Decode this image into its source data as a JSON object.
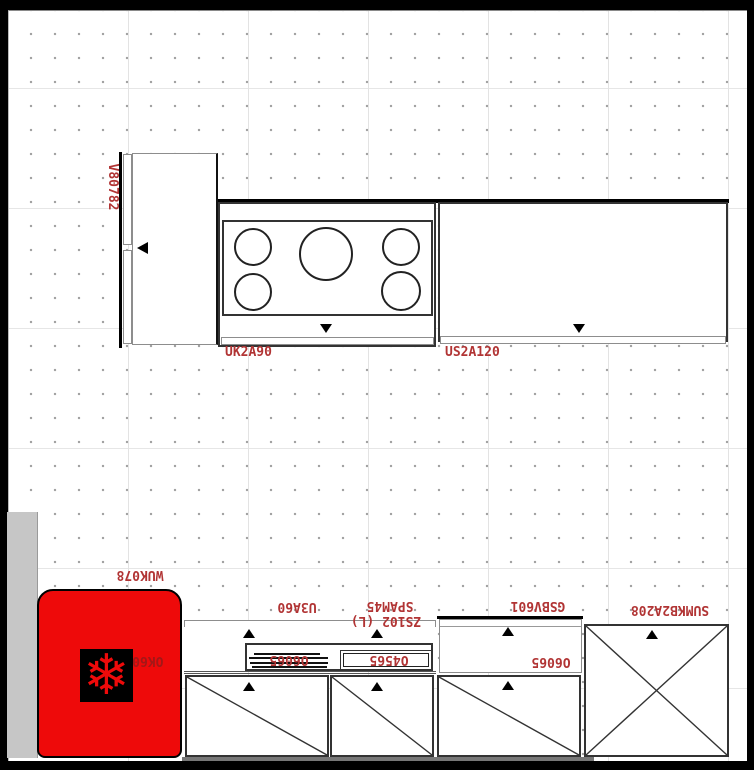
{
  "app": {
    "view_name": "kitchen-plan-canvas"
  },
  "colors": {
    "label_red": "#b13434",
    "fridge_red": "#ee0a0a",
    "fridge_model_red": "#8a1c1c",
    "line_dark": "#2a2a2a"
  },
  "icons": {
    "snowflake_glyph": "❄"
  },
  "labels": {
    "tall_cabinet": "V80782",
    "hob_cabinet": "UK2A90",
    "wide_cabinet": "US2A120",
    "fridge": "WUK078",
    "fridge_model": "OK6028",
    "wall_cabinet_small": "U3A60",
    "hood": "SPAM45",
    "sink_cabinet": "ZS102 (L)",
    "sink_drainer": "O6065",
    "sink_bowl": "O4565",
    "counter_right": "O6065",
    "upper_right_cabinet": "GSBV601",
    "tall_right_cabinet": "SUMKB2A208"
  }
}
